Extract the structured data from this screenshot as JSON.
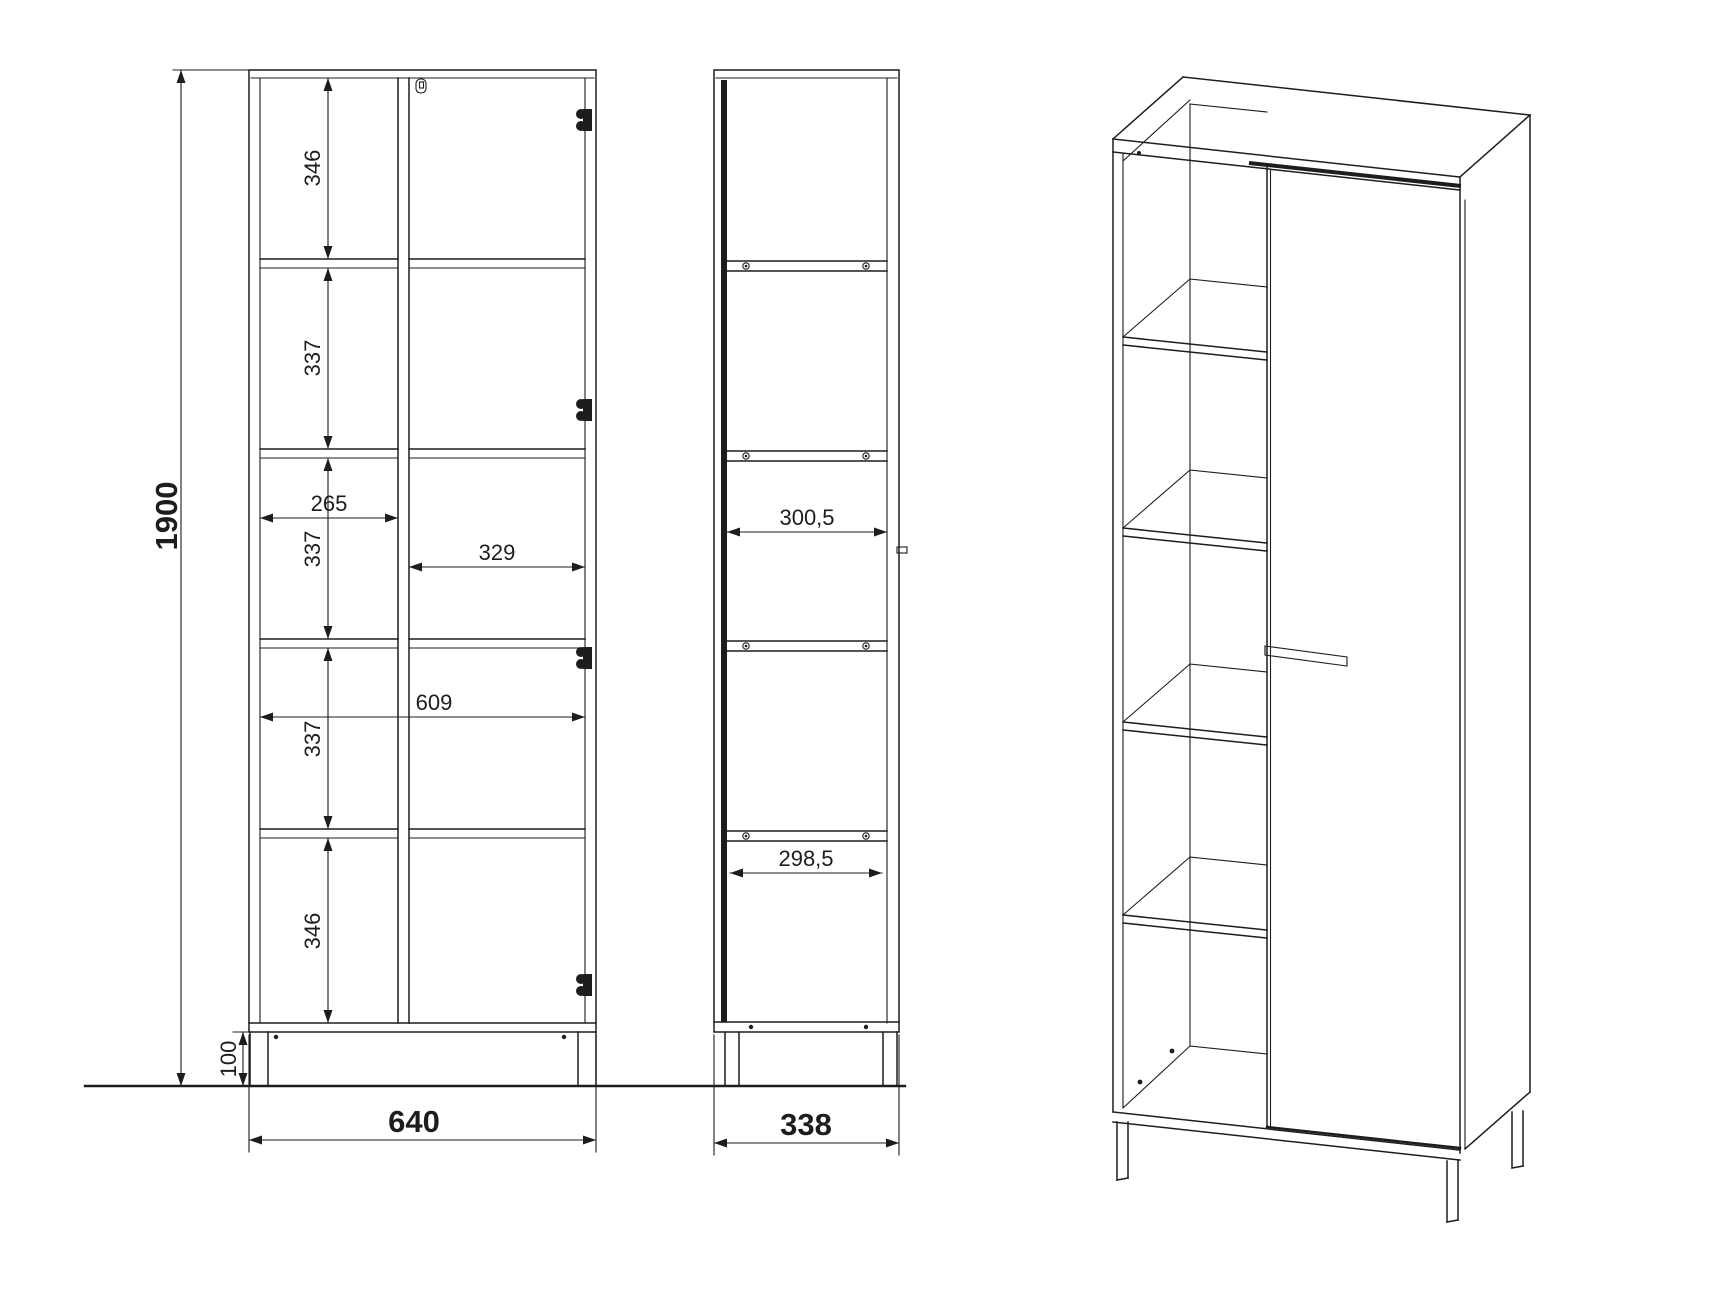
{
  "colors": {
    "line": "#1d1d1b",
    "background": "#ffffff"
  },
  "dimensions": {
    "overall_height": "1900",
    "leg_height": "100",
    "overall_width": "640",
    "overall_depth": "338",
    "compartment_1_height": "346",
    "compartment_2_height": "337",
    "compartment_3_height": "337",
    "compartment_4_height": "337",
    "compartment_5_height": "346",
    "left_compartment_width": "265",
    "right_compartment_width": "329",
    "interior_width": "609",
    "interior_depth_upper": "300,5",
    "interior_depth_lower": "298,5"
  }
}
